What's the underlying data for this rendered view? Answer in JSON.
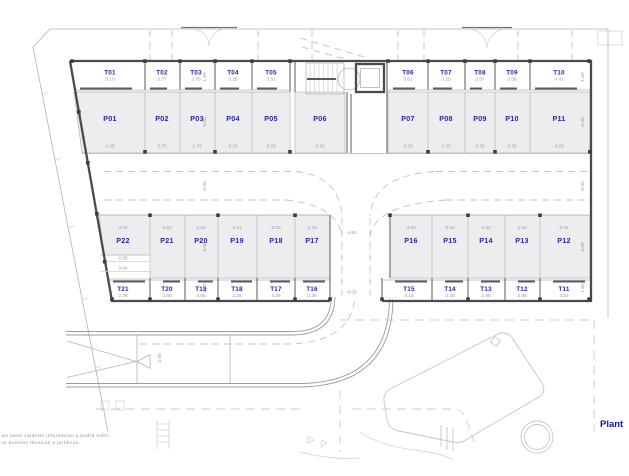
{
  "drawing": {
    "type": "parking-floor-plan",
    "plan_label": "Plant",
    "notes": {
      "line1": "eo tiene carácter informativo y podrá sufrir",
      "line2": "or motivos técnicos o jurídicos."
    }
  },
  "colors": {
    "label_blue": "#2626a8",
    "dim_gray": "#9a9a9e",
    "stall_fill": "#ededf0",
    "wall_dark": "#4b4b4f"
  },
  "plan": {
    "storage_top": [
      {
        "id": "T01",
        "width": "5.10"
      },
      {
        "id": "T02",
        "width": "2.77"
      },
      {
        "id": "T03",
        "width": "2.78"
      },
      {
        "id": "T04",
        "width": "3.25"
      },
      {
        "id": "T05",
        "width": "3.61"
      },
      {
        "id": "T06",
        "width": "3.61"
      },
      {
        "id": "T07",
        "width": "3.25"
      },
      {
        "id": "T08",
        "width": "2.37"
      },
      {
        "id": "T09",
        "width": "2.38"
      },
      {
        "id": "T10",
        "width": "4.41"
      }
    ],
    "parking_top": [
      {
        "id": "P01",
        "width": "4.25"
      },
      {
        "id": "P02",
        "width": "2.75"
      },
      {
        "id": "P03",
        "width": "2.75"
      },
      {
        "id": "P04",
        "width": "3.23"
      },
      {
        "id": "P05",
        "width": "3.23"
      },
      {
        "id": "P06",
        "width": "3.43"
      },
      {
        "id": "P07",
        "width": "3.23"
      },
      {
        "id": "P08",
        "width": "3.23"
      },
      {
        "id": "P09",
        "width": "2.35"
      },
      {
        "id": "P10",
        "width": "2.35"
      },
      {
        "id": "P11",
        "width": "4.25"
      }
    ],
    "parking_bottom": [
      {
        "id": "P22",
        "width": "3.76"
      },
      {
        "id": "P21",
        "width": "2.62"
      },
      {
        "id": "P20",
        "width": "2.62"
      },
      {
        "id": "P19",
        "width": "3.23"
      },
      {
        "id": "P18",
        "width": "3.23"
      },
      {
        "id": "P17",
        "width": "2.43"
      },
      {
        "id": "P16",
        "width": "3.23"
      },
      {
        "id": "P15",
        "width": "3.23"
      },
      {
        "id": "P14",
        "width": "2.83"
      },
      {
        "id": "P13",
        "width": "2.83"
      },
      {
        "id": "P12",
        "width": "3.42"
      }
    ],
    "storage_bottom": [
      {
        "id": "T21",
        "width": "2.78"
      },
      {
        "id": "T20",
        "width": "2.65"
      },
      {
        "id": "T19",
        "width": "2.65"
      },
      {
        "id": "T18",
        "width": "3.25"
      },
      {
        "id": "T17",
        "width": "3.25"
      },
      {
        "id": "T16",
        "width": "2.36"
      },
      {
        "id": "T15",
        "width": "4.15"
      },
      {
        "id": "T14",
        "width": "3.25"
      },
      {
        "id": "T13",
        "width": "2.85"
      },
      {
        "id": "T12",
        "width": "2.85"
      },
      {
        "id": "T11",
        "width": "3.52"
      }
    ]
  },
  "dimensions": {
    "storage_depth": "1.60",
    "parking_depth": "5.00",
    "aisle_width": "5.00",
    "entry_gap": "4.62",
    "entry_lane": "4.00",
    "ramp_width": "4.00",
    "p22_inner": "2.98",
    "p22_outer": "3.04"
  }
}
